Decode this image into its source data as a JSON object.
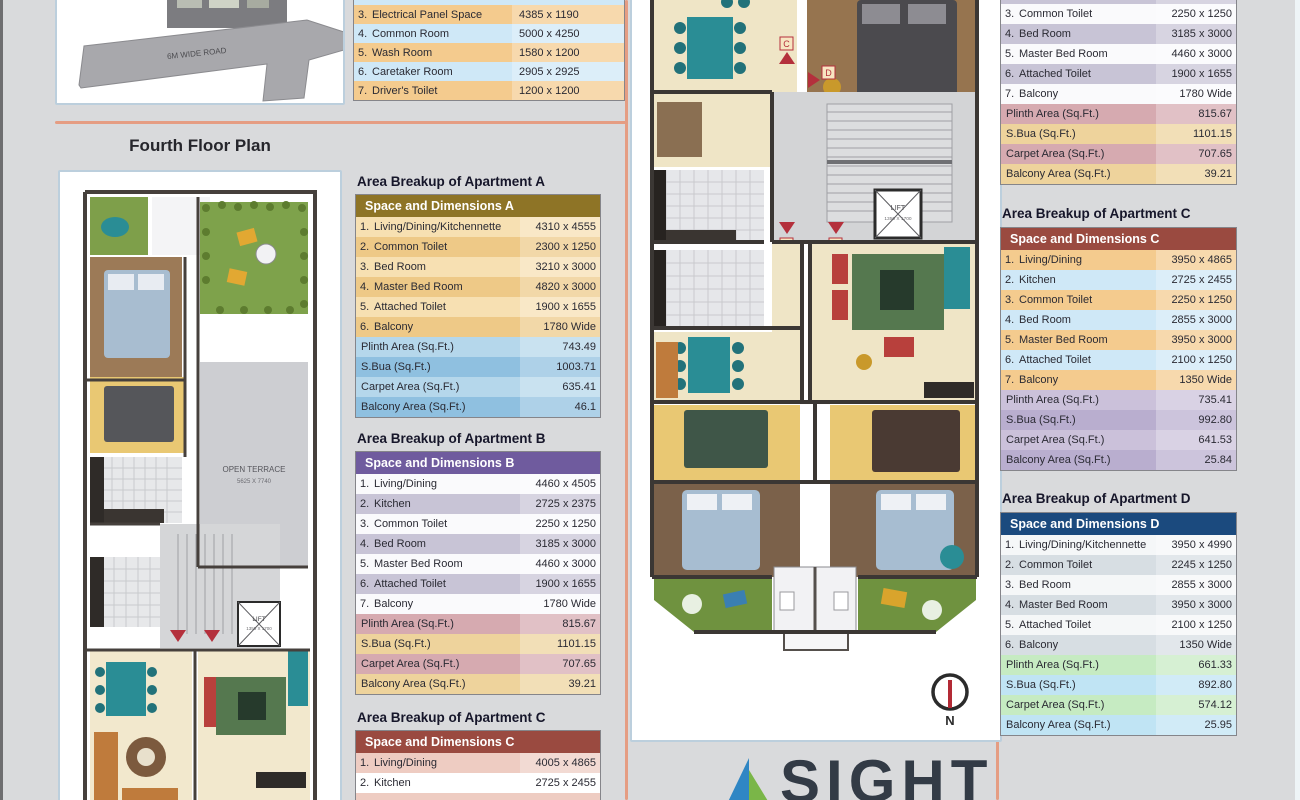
{
  "floor_heading": "Fourth Floor Plan",
  "site_plan": {
    "road_label": "6M WIDE ROAD"
  },
  "plans": {
    "open_terrace": "OPEN TERRACE",
    "terrace_dim": "5625 X 7740",
    "lift": "LIFT",
    "lift_dim": "1350 X 1700",
    "north": "N",
    "units": {
      "a": "A",
      "b": "B",
      "c": "C",
      "d": "D"
    }
  },
  "logo": {
    "text": "SIGHT"
  },
  "amenities": {
    "rows": [
      {
        "no": "3.",
        "name": "Electrical Panel Space",
        "dim": "4385 x 1190"
      },
      {
        "no": "4.",
        "name": "Common Room",
        "dim": "5000 x 4250"
      },
      {
        "no": "5.",
        "name": "Wash Room",
        "dim": "1580 x 1200"
      },
      {
        "no": "6.",
        "name": "Caretaker Room",
        "dim": "2905 x 2925"
      },
      {
        "no": "7.",
        "name": "Driver's Toilet",
        "dim": "1200 x 1200"
      }
    ]
  },
  "apartment_a": {
    "title": "Area Breakup of Apartment A",
    "header": "Space and Dimensions A",
    "rows": [
      {
        "no": "1.",
        "name": "Living/Dining/Kitchennette",
        "dim": "4310 x 4555"
      },
      {
        "no": "2.",
        "name": "Common Toilet",
        "dim": "2300 x 1250"
      },
      {
        "no": "3.",
        "name": "Bed Room",
        "dim": "3210 x 3000"
      },
      {
        "no": "4.",
        "name": "Master Bed Room",
        "dim": "4820 x 3000"
      },
      {
        "no": "5.",
        "name": "Attached Toilet",
        "dim": "1900 x 1655"
      },
      {
        "no": "6.",
        "name": "Balcony",
        "dim": "1780 Wide"
      }
    ],
    "summary": [
      {
        "name": "Plinth Area (Sq.Ft.)",
        "value": "743.49"
      },
      {
        "name": "S.Bua (Sq.Ft.)",
        "value": "1003.71"
      },
      {
        "name": "Carpet Area (Sq.Ft.)",
        "value": "635.41"
      },
      {
        "name": "Balcony Area (Sq.Ft.)",
        "value": "46.1"
      }
    ]
  },
  "apartment_b": {
    "title": "Area Breakup of Apartment B",
    "header": "Space and Dimensions B",
    "rows": [
      {
        "no": "1.",
        "name": "Living/Dining",
        "dim": "4460 x 4505"
      },
      {
        "no": "2.",
        "name": "Kitchen",
        "dim": "2725 x 2375"
      },
      {
        "no": "3.",
        "name": "Common Toilet",
        "dim": "2250 x 1250"
      },
      {
        "no": "4.",
        "name": "Bed Room",
        "dim": "3185 x 3000"
      },
      {
        "no": "5.",
        "name": "Master Bed Room",
        "dim": "4460 x 3000"
      },
      {
        "no": "6.",
        "name": "Attached Toilet",
        "dim": "1900 x 1655"
      },
      {
        "no": "7.",
        "name": "Balcony",
        "dim": "1780 Wide"
      }
    ],
    "summary": [
      {
        "name": "Plinth Area (Sq.Ft.)",
        "value": "815.67"
      },
      {
        "name": "S.Bua (Sq.Ft.)",
        "value": "1101.15"
      },
      {
        "name": "Carpet Area (Sq.Ft.)",
        "value": "707.65"
      },
      {
        "name": "Balcony Area (Sq.Ft.)",
        "value": "39.21"
      }
    ]
  },
  "apartment_b_cont": {
    "rows": [
      {
        "no": "2.",
        "name": "Kitchen",
        "dim": "2725 x 2375"
      },
      {
        "no": "3.",
        "name": "Common Toilet",
        "dim": "2250 x 1250"
      },
      {
        "no": "4.",
        "name": "Bed Room",
        "dim": "3185 x 3000"
      },
      {
        "no": "5.",
        "name": "Master Bed Room",
        "dim": "4460 x 3000"
      },
      {
        "no": "6.",
        "name": "Attached Toilet",
        "dim": "1900 x 1655"
      },
      {
        "no": "7.",
        "name": "Balcony",
        "dim": "1780 Wide"
      }
    ],
    "summary": [
      {
        "name": "Plinth Area (Sq.Ft.)",
        "value": "815.67"
      },
      {
        "name": "S.Bua (Sq.Ft.)",
        "value": "1101.15"
      },
      {
        "name": "Carpet Area (Sq.Ft.)",
        "value": "707.65"
      },
      {
        "name": "Balcony Area (Sq.Ft.)",
        "value": "39.21"
      }
    ]
  },
  "apartment_c_mid": {
    "title": "Area Breakup of Apartment C",
    "header": "Space and Dimensions C",
    "rows": [
      {
        "no": "1.",
        "name": "Living/Dining",
        "dim": "4005 x 4865"
      },
      {
        "no": "2.",
        "name": "Kitchen",
        "dim": "2725 x 2455"
      }
    ]
  },
  "apartment_c": {
    "title": "Area Breakup of Apartment C",
    "header": "Space and Dimensions C",
    "rows": [
      {
        "no": "1.",
        "name": "Living/Dining",
        "dim": "3950 x 4865"
      },
      {
        "no": "2.",
        "name": "Kitchen",
        "dim": "2725 x 2455"
      },
      {
        "no": "3.",
        "name": "Common Toilet",
        "dim": "2250 x 1250"
      },
      {
        "no": "4.",
        "name": "Bed Room",
        "dim": "2855 x 3000"
      },
      {
        "no": "5.",
        "name": "Master Bed Room",
        "dim": "3950 x 3000"
      },
      {
        "no": "6.",
        "name": "Attached Toilet",
        "dim": "2100 x 1250"
      },
      {
        "no": "7.",
        "name": "Balcony",
        "dim": "1350 Wide"
      }
    ],
    "summary": [
      {
        "name": "Plinth Area (Sq.Ft.)",
        "value": "735.41"
      },
      {
        "name": "S.Bua (Sq.Ft.)",
        "value": "992.80"
      },
      {
        "name": "Carpet Area (Sq.Ft.)",
        "value": "641.53"
      },
      {
        "name": "Balcony Area (Sq.Ft.)",
        "value": "25.84"
      }
    ]
  },
  "apartment_d": {
    "title": "Area Breakup of Apartment D",
    "header": "Space and Dimensions D",
    "rows": [
      {
        "no": "1.",
        "name": "Living/Dining/Kitchennette",
        "dim": "3950 x 4990"
      },
      {
        "no": "2.",
        "name": "Common Toilet",
        "dim": "2245 x 1250"
      },
      {
        "no": "3.",
        "name": "Bed Room",
        "dim": "2855 x 3000"
      },
      {
        "no": "4.",
        "name": "Master Bed Room",
        "dim": "3950 x 3000"
      },
      {
        "no": "5.",
        "name": "Attached Toilet",
        "dim": "2100 x 1250"
      },
      {
        "no": "6.",
        "name": "Balcony",
        "dim": "1350 Wide"
      }
    ],
    "summary": [
      {
        "name": "Plinth Area (Sq.Ft.)",
        "value": "661.33"
      },
      {
        "name": "S.Bua (Sq.Ft.)",
        "value": "892.80"
      },
      {
        "name": "Carpet Area (Sq.Ft.)",
        "value": "574.12"
      },
      {
        "name": "Balcony Area (Sq.Ft.)",
        "value": "25.95"
      }
    ]
  }
}
